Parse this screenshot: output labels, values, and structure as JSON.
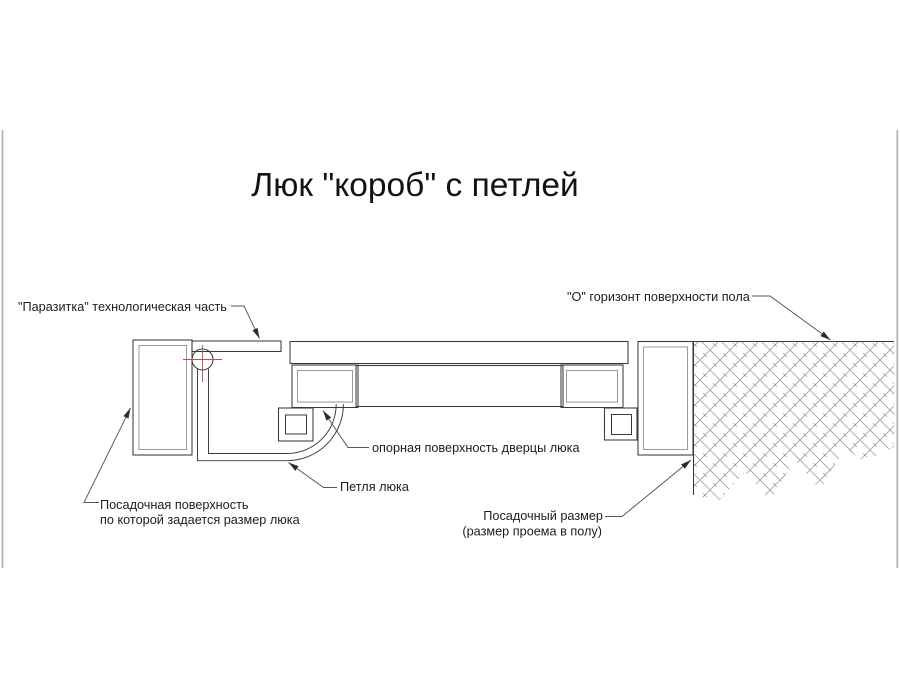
{
  "title": "Люк \"короб\" с петлей",
  "diagram": {
    "labels": {
      "parasitka": "\"Паразитка\" технологическая часть",
      "floor_horizon": "\"О\" горизонт поверхности пола",
      "door_support_surface": "опорная поверхность дверцы люка",
      "hinge": "Петля люка",
      "seat_surface_line1": "Посадочная поверхность",
      "seat_surface_line2": "по которой задается размер люка",
      "seat_size_line1": "Посадочный размер",
      "seat_size_line2": "(размер проема в полу)"
    }
  },
  "colors": {
    "line": "#3a3a3a",
    "leader": "#565656",
    "text": "#1d1d1d",
    "hatch": "#8f8f8f",
    "red": "#b6524e",
    "photo_edge": "#b3b3b3"
  }
}
